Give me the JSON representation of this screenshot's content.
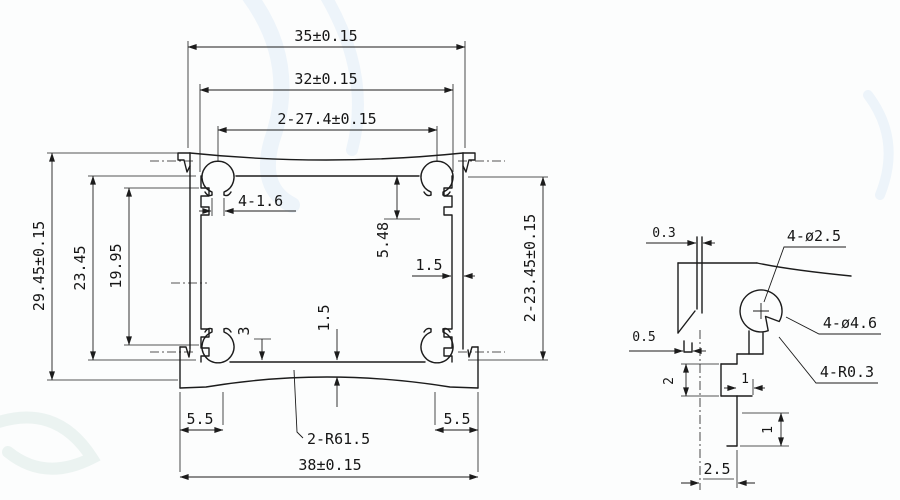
{
  "colors": {
    "line": "#1c1c1c",
    "paper": "#fcfdfd",
    "watermark_blue": "#edf4fa",
    "watermark_teal": "#ebf3f1"
  },
  "main_view": {
    "dims": {
      "width_top": "35±0.15",
      "width_inner": "32±0.15",
      "boss_spacing": "2-27.4±0.15",
      "height_overall": "29.45±0.15",
      "height_inner": "23.45",
      "height_slot": "19.95",
      "height_side": "2-23.45±0.15",
      "boss_depth": "5.48",
      "slot_width": "4-1.6",
      "side_wall": "1.5",
      "bottom_wall": "1.5",
      "rib_offset": "3",
      "flange_left": "5.5",
      "flange_right": "5.5",
      "bottom_radius": "2-R61.5",
      "width_bottom": "38±0.15"
    }
  },
  "detail_view": {
    "dims": {
      "groove_width": "0.3",
      "lip_width": "0.5",
      "screw_hole": "4-ø2.5",
      "boss_outer": "4-ø4.6",
      "notch_radius": "4-R0.3",
      "step_height": "2",
      "step_a": "1",
      "step_b": "1",
      "base_width": "2.5"
    }
  }
}
